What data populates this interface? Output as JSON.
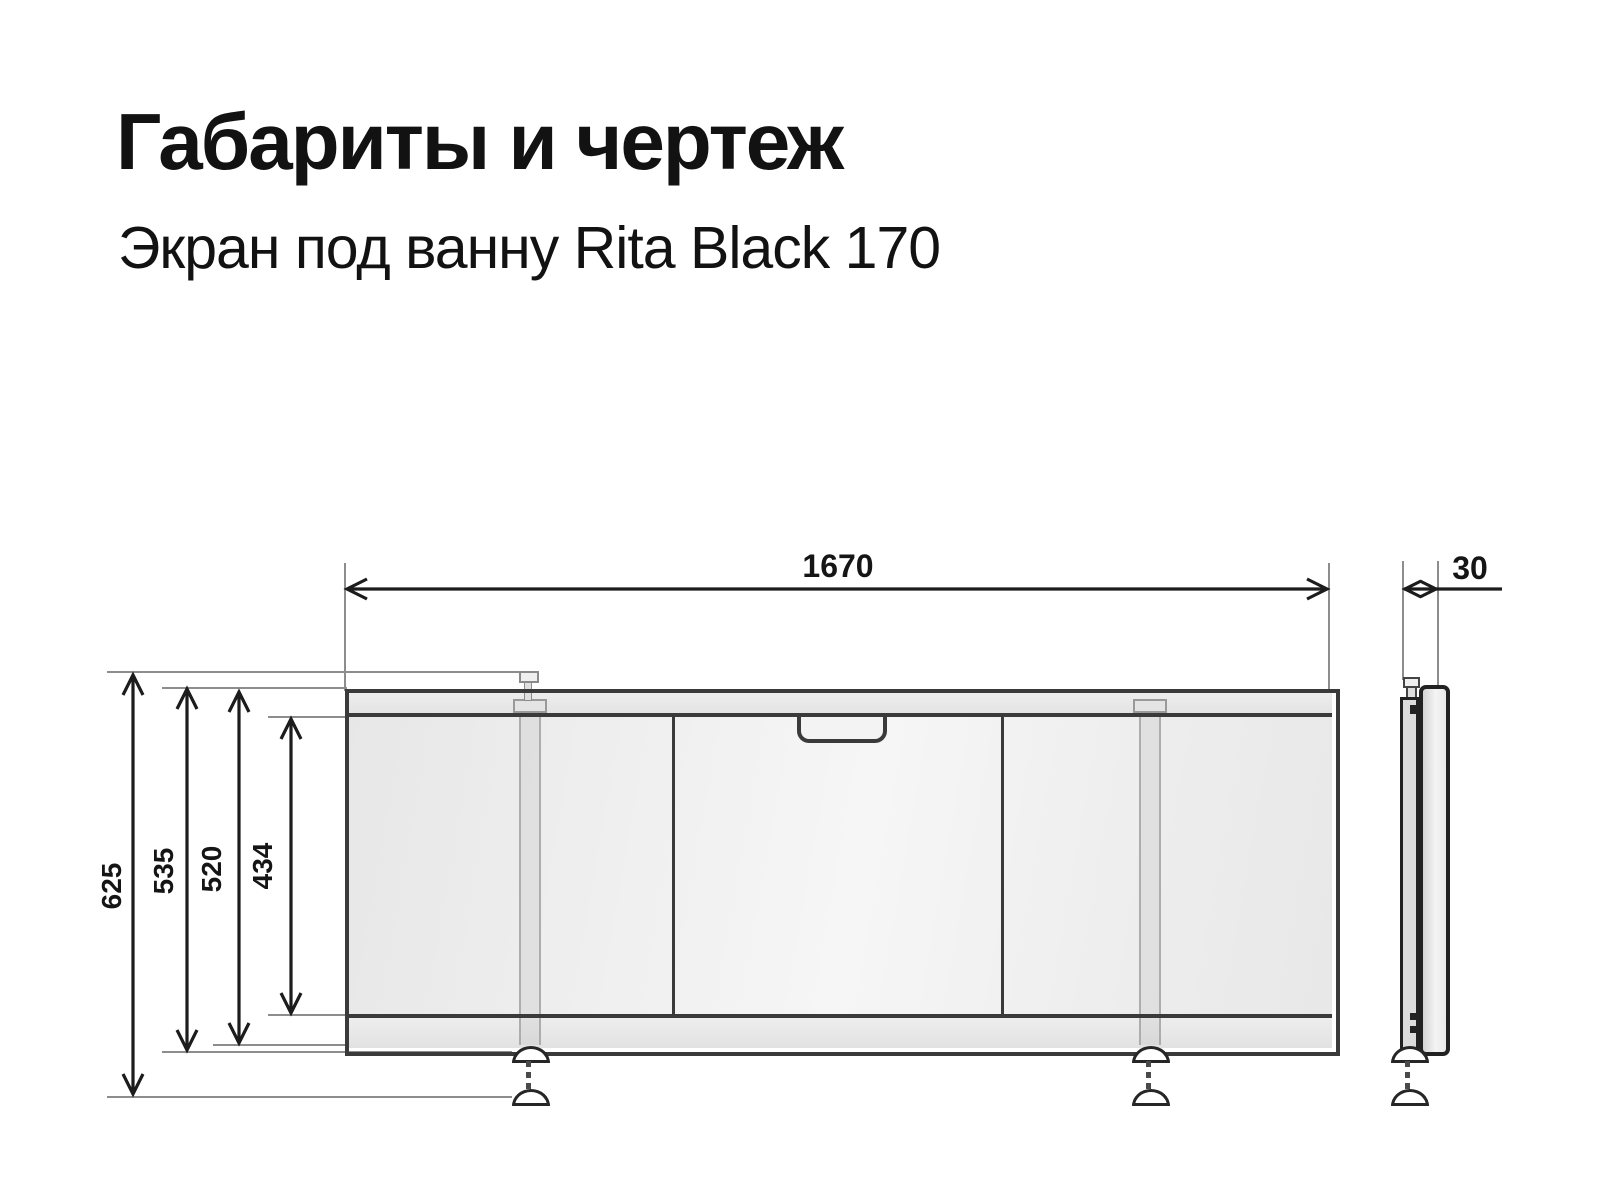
{
  "header": {
    "title": "Габариты и чертеж",
    "subtitle": "Экран под ванну Rita Black 170"
  },
  "drawing": {
    "type": "technical-dimension-drawing",
    "views": {
      "front_view": "bath screen front: top rail, 3 sliding panels, handle on middle panel, 2 adjustable legs with feet",
      "side_view": "bath screen profile with leg and foot"
    },
    "dimensions": {
      "width_mm": {
        "label": "1670"
      },
      "depth_mm": {
        "label": "30"
      },
      "height_total_mm": {
        "label": "625"
      },
      "height_with_foot_mm": {
        "label": "535"
      },
      "height_screen_mm": {
        "label": "520"
      },
      "height_panel_mm": {
        "label": "434"
      }
    },
    "colors": {
      "ink": "#1c1c1c",
      "outline": "#3a3a3a",
      "extension_line": "#8d8d8d",
      "rail_fill": "#e9e9e9",
      "panel_fill": "#f2f2f2"
    }
  }
}
